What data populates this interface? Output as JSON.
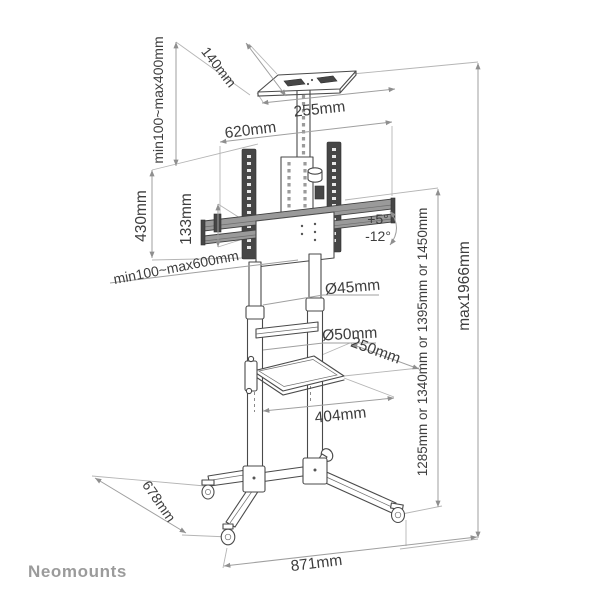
{
  "brand": "Neomounts",
  "drawing": {
    "labels": {
      "top_height_range": "min100~max400mm",
      "top_tray_depth": "140mm",
      "top_tray_width": "255mm",
      "bracket_width": "620mm",
      "bracket_height": "430mm",
      "crossbar_gap": "133mm",
      "tilt_up": "+5°",
      "tilt_down": "-12°",
      "mount_height_range": "min100~max600mm",
      "upper_pole_diameter": "Ø45mm",
      "lower_pole_diameter": "Ø50mm",
      "shelf_depth": "250mm",
      "shelf_width": "404mm",
      "pole_height_options": "1285mm or 1340mm or 1395mm or 1450mm",
      "max_height": "max1966mm",
      "base_depth": "678mm",
      "base_width": "871mm"
    },
    "colors": {
      "structure_line": "#4a4a4a",
      "dimension_line": "#9f9f9f",
      "label_text": "#3d3d3d",
      "brand_text": "#9b9b9b",
      "rail_fill": "#464646"
    }
  }
}
